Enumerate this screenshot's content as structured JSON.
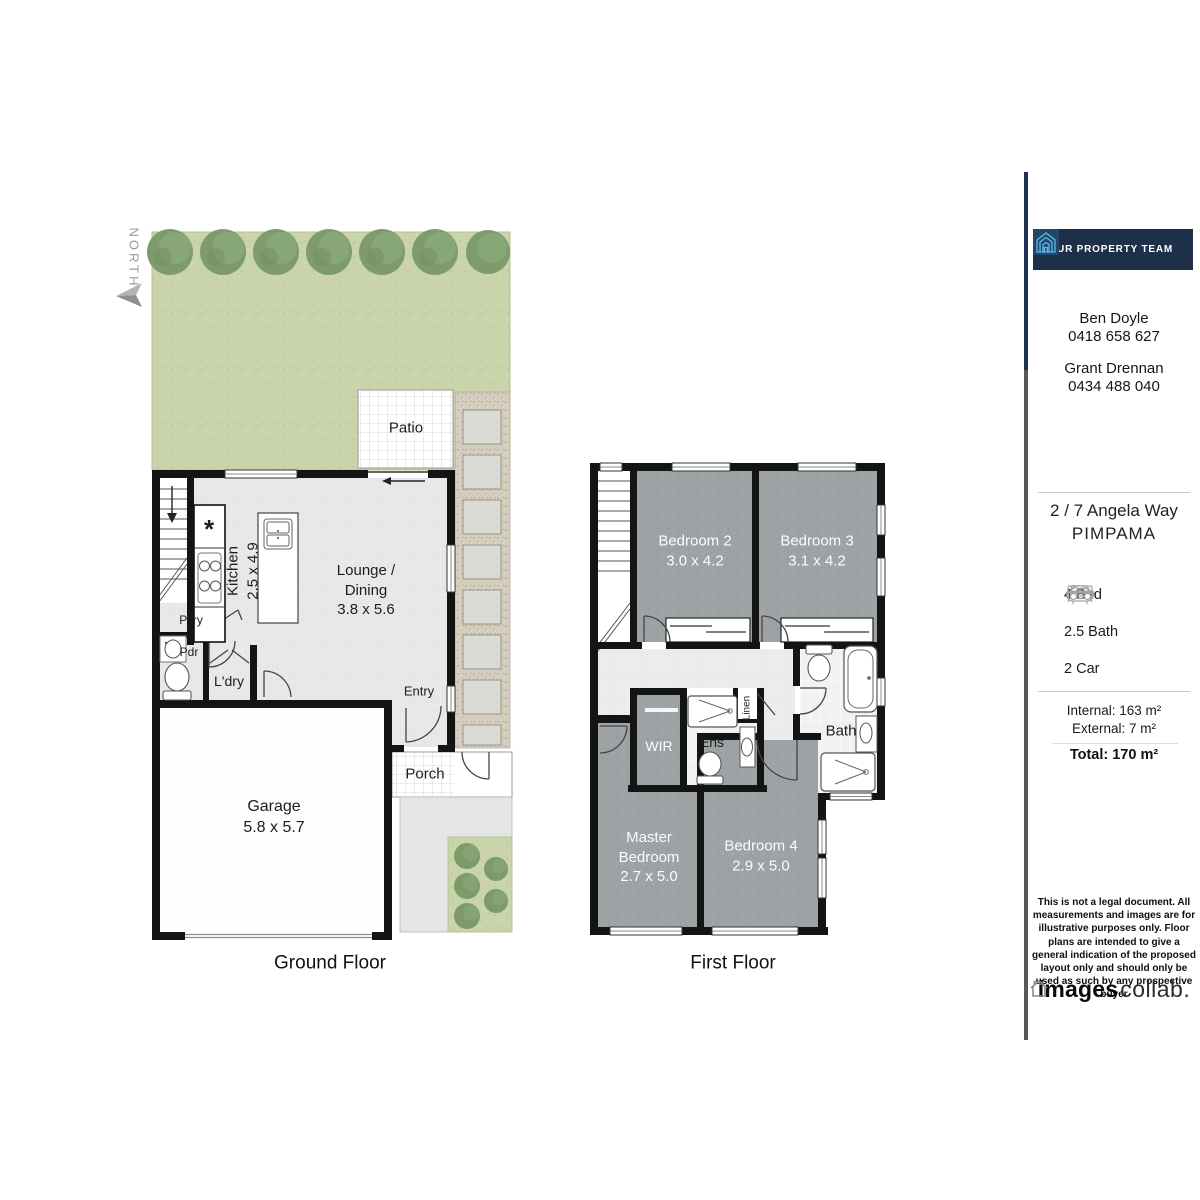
{
  "north": {
    "label": "NORTH"
  },
  "ground_floor": {
    "title": "Ground Floor",
    "labels": {
      "patio": "Patio",
      "kitchen": "Kitchen\n2.5 x 4.9",
      "kitchen_symbol": "*",
      "lounge": "Lounge /\nDining\n3.8 x 5.6",
      "pantry": "P'try",
      "powder": "Pdr",
      "laundry": "L'dry",
      "entry": "Entry",
      "garage": "Garage\n5.8 x 5.7",
      "porch": "Porch"
    }
  },
  "first_floor": {
    "title": "First Floor",
    "labels": {
      "bedroom2": "Bedroom 2\n3.0 x 4.2",
      "bedroom3": "Bedroom 3\n3.1 x 4.2",
      "wir": "WIR",
      "ensuite": "Ens",
      "linen": "Linen",
      "bath": "Bath",
      "master": "Master\nBedroom\n2.7 x 5.0",
      "bedroom4": "Bedroom 4\n2.9 x 5.0"
    }
  },
  "sidebar": {
    "brand": "YOUR PROPERTY TEAM",
    "agents": [
      {
        "name": "Ben Doyle",
        "phone": "0418 658 627"
      },
      {
        "name": "Grant Drennan",
        "phone": "0434 488 040"
      }
    ],
    "address_line1": "2 / 7 Angela Way",
    "address_line2": "PIMPAMA",
    "features": [
      {
        "icon": "bed-icon",
        "label": "4 Bed"
      },
      {
        "icon": "bath-icon",
        "label": "2.5 Bath"
      },
      {
        "icon": "car-icon",
        "label": "2 Car"
      }
    ],
    "areas": {
      "internal": "Internal: 163 m²",
      "external": "External: 7 m²",
      "total": "Total: 170 m²"
    },
    "disclaimer": "This is not a legal document. All measurements and images are for illustrative purposes only. Floor plans are intended to give a general indication of the proposed layout only and should only be used as such by any prospective buyer",
    "logo": {
      "bold": "images",
      "light": "collab."
    }
  },
  "colors": {
    "wall": "#141414",
    "carpet": "#9da2a4",
    "garden": "#c9d4aa",
    "navy": "#1e2f4a",
    "logo_blue": "#57bfe9",
    "muted_gray": "#9b9b9b"
  }
}
